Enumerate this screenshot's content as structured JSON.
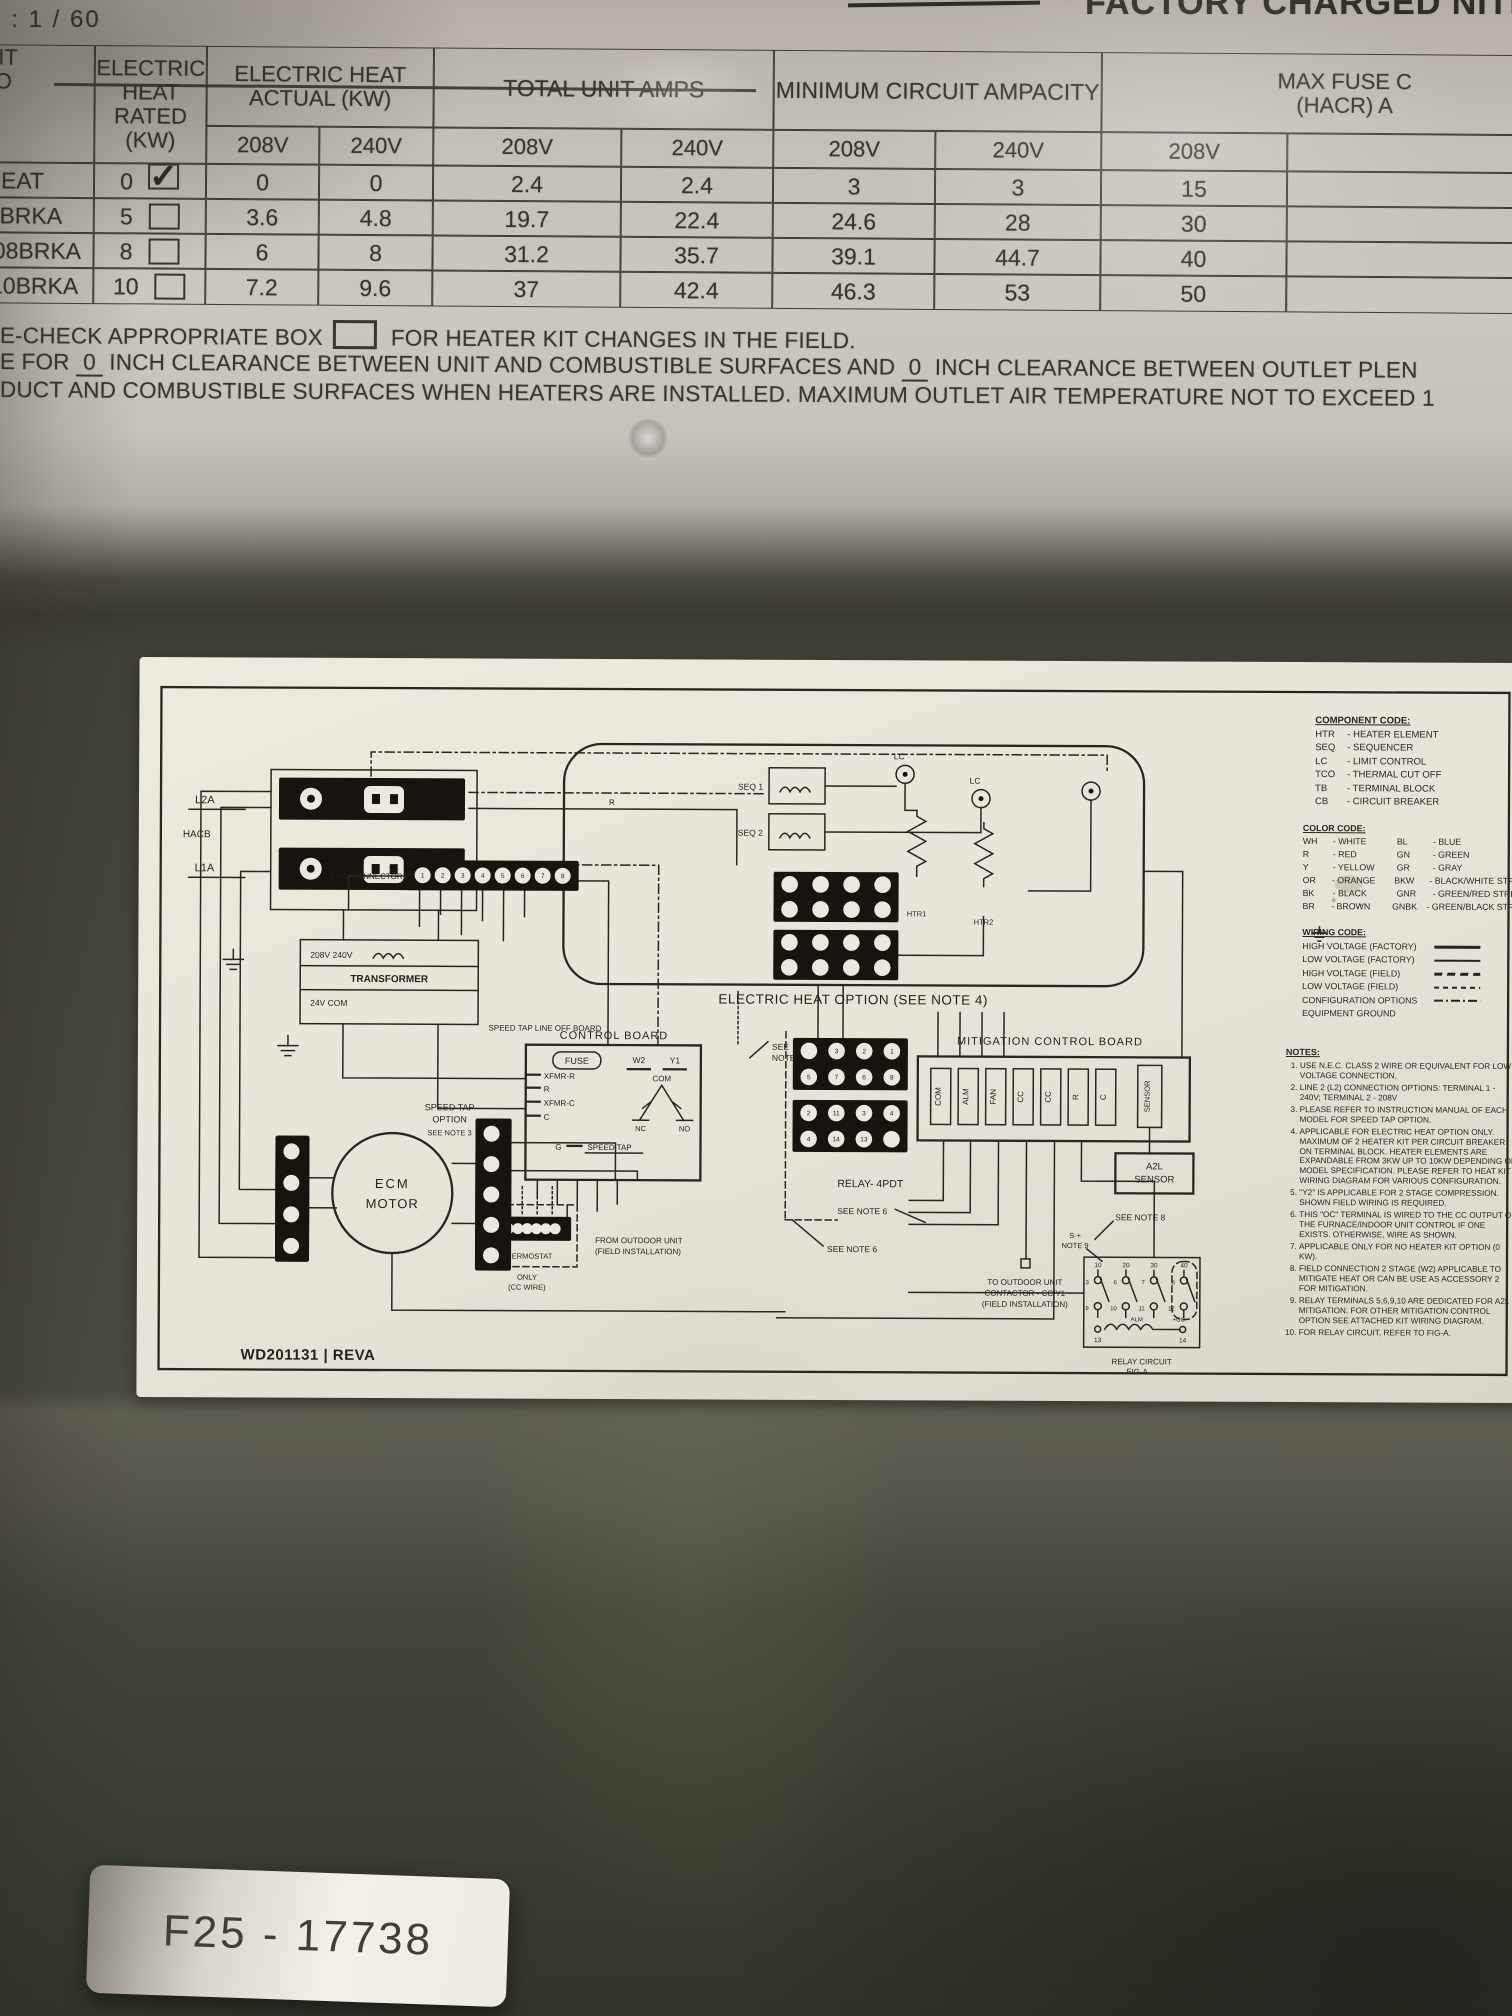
{
  "top": {
    "marker_left": "Z : 1 / 60",
    "marker_right": "FACTORY CHARGED NITROGEN"
  },
  "ratings_table": {
    "headers": {
      "kit1": "ER KIT",
      "kit2": "EL NO",
      "rated1": "ELECTRIC",
      "rated2": "HEAT RATED",
      "rated3": "(KW)",
      "actual1": "ELECTRIC HEAT",
      "actual2": "ACTUAL (KW)",
      "total": "TOTAL UNIT AMPS",
      "mca": "MINIMUM CIRCUIT AMPACITY",
      "fuse1": "MAX FUSE C",
      "fuse2": "(HACR) A",
      "v208": "208V",
      "v240": "240V"
    },
    "rows": [
      {
        "model": "EC HEAT",
        "rated": "0",
        "checked": true,
        "values": [
          "0",
          "0",
          "2.4",
          "2.4",
          "3",
          "3",
          "15"
        ]
      },
      {
        "model": "A505BRKA",
        "rated": "5",
        "checked": false,
        "values": [
          "3.6",
          "4.8",
          "19.7",
          "22.4",
          "24.6",
          "28",
          "30"
        ]
      },
      {
        "model": "RAS08BRKA",
        "rated": "8",
        "checked": false,
        "values": [
          "6",
          "8",
          "31.2",
          "35.7",
          "39.1",
          "44.7",
          "40"
        ]
      },
      {
        "model": "RA510BRKA",
        "rated": "10",
        "checked": false,
        "values": [
          "7.2",
          "9.6",
          "37",
          "42.4",
          "46.3",
          "53",
          "50"
        ]
      }
    ]
  },
  "field_lines": {
    "check1": "E-CHECK APPROPRIATE BOX",
    "check2": "FOR HEATER KIT CHANGES IN THE FIELD.",
    "clearance": [
      "E FOR ",
      "0",
      " INCH CLEARANCE BETWEEN UNIT AND COMBUSTIBLE SURFACES AND ",
      "0",
      " INCH CLEARANCE BETWEEN OUTLET PLEN"
    ],
    "duct": "DUCT AND COMBUSTIBLE SURFACES WHEN HEATERS ARE INSTALLED. MAXIMUM OUTLET AIR TEMPERATURE NOT TO EXCEED 1"
  },
  "diagram": {
    "labels": {
      "l2a": "L2A",
      "hacb": "HACB",
      "l1a": "L1A",
      "xfmr1": "208V  240V",
      "xfmr2": "TRANSFORMER",
      "xfmr3": "24V  COM",
      "lpw": "LPW CONNECTOR",
      "speed_tap_line": "SPEED TAP LINE OFF BOARD",
      "control_board": "CONTROL BOARD",
      "fuse": "FUSE",
      "w2": "W2",
      "y1": "Y1",
      "com": "COM",
      "nc": "NC",
      "no": "NO",
      "xfmr_r": "XFMR-R",
      "r": "R",
      "xfmr_c": "XFMR-C",
      "c": "C",
      "g": "G",
      "speed_tap": "SPEED TAP",
      "wire_r": "R",
      "note7a": "SEE",
      "note7b": "NOTE 7",
      "speed_opt1": "SPEED TAP",
      "speed_opt2": "OPTION",
      "speed_opt3": "SEE NOTE 3",
      "ecm1": "ECM",
      "ecm2": "MOTOR",
      "heat_caption": "ELECTRIC HEAT OPTION (SEE NOTE 4)",
      "seq1": "SEQ 1",
      "seq2": "SEQ 2",
      "lc1": "LC",
      "lc2": "LC",
      "htr1": "HTR1",
      "htr2": "HTR2",
      "mit_title": "MITIGATION CONTROL BOARD",
      "a2l1": "A2L",
      "a2l2": "SENSOR",
      "relay": "RELAY- 4PDT",
      "note6a": "SEE NOTE 6",
      "note6b": "SEE NOTE 6",
      "note8": "SEE NOTE 8",
      "note9a": "S-+",
      "note9b": "NOTE 9",
      "outdoor1": "TO OUTDOOR UNIT",
      "outdoor2": "CONTACTOR - CC/Y1",
      "outdoor3": "(FIELD INSTALLATION)",
      "thermo1": "THERMOSTAT",
      "thermo2": "ONLY",
      "thermo3": "(CC WIRE)",
      "from_outdoor1": "FROM OUTDOOR UNIT",
      "from_outdoor2": "(FIELD INSTALLATION)",
      "fig1": "RELAY CIRCUIT",
      "fig2": "FIG-A",
      "alm": "ALM",
      "pcc": "+CC",
      "wd": "WD201131 | REVA"
    },
    "mitigation": {
      "terminals": [
        "COM",
        "ALM",
        "FAN",
        "CC",
        "CC",
        "R",
        "C"
      ],
      "sensor": "SENSOR"
    },
    "fig": {
      "top": [
        "10",
        "20",
        "30",
        "40"
      ],
      "mid": [
        "3",
        "6",
        "7",
        "8"
      ],
      "low": [
        "9",
        "10",
        "11",
        "12"
      ],
      "bottom": [
        "13",
        "14"
      ]
    },
    "grids": [
      {
        "name": "lpw-connector-strip",
        "x": 268,
        "y": 202,
        "w": 172,
        "h": 30,
        "r": 8,
        "rows": [
          [
            "1",
            "2",
            "3",
            "4",
            "5",
            "6",
            "7",
            "8"
          ]
        ]
      },
      {
        "name": "thermostat-strip",
        "x": 346,
        "y": 558,
        "w": 88,
        "h": 24,
        "r": 5.5,
        "rows": [
          [
            "",
            "",
            "",
            "",
            "",
            "",
            ""
          ]
        ]
      },
      {
        "name": "motor-strip-left",
        "x": 138,
        "y": 478,
        "w": 34,
        "h": 126,
        "r": 8,
        "rows": [
          [
            ""
          ],
          [
            ""
          ],
          [
            ""
          ],
          [
            ""
          ]
        ]
      },
      {
        "name": "motor-strip-right",
        "x": 338,
        "y": 460,
        "w": 36,
        "h": 152,
        "r": 8,
        "rows": [
          [
            ""
          ],
          [
            ""
          ],
          [
            ""
          ],
          [
            ""
          ],
          [
            ""
          ]
        ]
      },
      {
        "name": "heat-terminal-block-a",
        "x": 635,
        "y": 212,
        "w": 125,
        "h": 50,
        "r": 8.3,
        "rows": [
          [
            "",
            "",
            "",
            ""
          ],
          [
            "",
            "",
            "",
            ""
          ]
        ]
      },
      {
        "name": "heat-terminal-block-b",
        "x": 635,
        "y": 270,
        "w": 125,
        "h": 50,
        "r": 8.3,
        "rows": [
          [
            "",
            "",
            "",
            ""
          ],
          [
            "",
            "",
            "",
            ""
          ]
        ]
      },
      {
        "name": "relay-block-a",
        "x": 655,
        "y": 378,
        "w": 115,
        "h": 52,
        "r": 8.3,
        "rows": [
          [
            "",
            "3",
            "2",
            "1"
          ],
          [
            "5",
            "7",
            "6",
            "8"
          ]
        ]
      },
      {
        "name": "relay-block-b",
        "x": 655,
        "y": 440,
        "w": 115,
        "h": 52,
        "r": 8.3,
        "rows": [
          [
            "2",
            "11",
            "3",
            "4"
          ],
          [
            "4",
            "14",
            "13",
            ""
          ]
        ]
      }
    ],
    "legend": {
      "component": {
        "title": "COMPONENT CODE:",
        "items": [
          [
            "HTR",
            "- HEATER ELEMENT"
          ],
          [
            "SEQ",
            "- SEQUENCER"
          ],
          [
            "LC",
            "- LIMIT CONTROL"
          ],
          [
            "TCO",
            "- THERMAL CUT OFF"
          ],
          [
            "TB",
            "- TERMINAL BLOCK"
          ],
          [
            "CB",
            "- CIRCUIT BREAKER"
          ]
        ]
      },
      "color": {
        "title": "COLOR CODE:",
        "rows": [
          [
            "WH",
            "- WHITE",
            "BL",
            "- BLUE"
          ],
          [
            "R",
            "- RED",
            "GN",
            "- GREEN"
          ],
          [
            "Y",
            "- YELLOW",
            "GR",
            "- GRAY"
          ],
          [
            "OR",
            "- ORANGE",
            "BKW",
            "- BLACK/WHITE STRIPE"
          ],
          [
            "BK",
            "- BLACK",
            "GNR",
            "- GREEN/RED STRIPE"
          ],
          [
            "BR",
            "- BROWN",
            "GNBK",
            "- GREEN/BLACK STRIPE"
          ]
        ]
      },
      "wiring": {
        "title": "WIRING CODE:",
        "items": [
          {
            "label": "HIGH VOLTAGE (FACTORY)",
            "style": "solid-thick"
          },
          {
            "label": "LOW VOLTAGE (FACTORY)",
            "style": "solid"
          },
          {
            "label": "HIGH VOLTAGE (FIELD)",
            "style": "dash"
          },
          {
            "label": "LOW VOLTAGE (FIELD)",
            "style": "dash-sm"
          },
          {
            "label": "CONFIGURATION OPTIONS",
            "style": "dashdot"
          },
          {
            "label": "EQUIPMENT GROUND",
            "style": "ground"
          }
        ]
      },
      "notes": {
        "title": "NOTES:",
        "items": [
          "USE N.E.C. CLASS 2 WIRE OR EQUIVALENT FOR LOW VOLTAGE CONNECTION.",
          "LINE 2 (L2) CONNECTION OPTIONS: TERMINAL 1 - 240V; TERMINAL 2 - 208V",
          "PLEASE REFER TO INSTRUCTION MANUAL OF EACH MODEL FOR SPEED TAP OPTION.",
          "APPLICABLE FOR ELECTRIC HEAT OPTION ONLY. MAXIMUM OF 2 HEATER KIT PER CIRCUIT BREAKER ON TERMINAL BLOCK. HEATER ELEMENTS ARE EXPANDABLE FROM 3KW UP TO 10KW DEPENDING ON MODEL SPECIFICATION. PLEASE REFER TO HEAT KIT WIRING DIAGRAM FOR VARIOUS CONFIGURATION.",
          "\"Y2\" IS APPLICABLE FOR 2 STAGE COMPRESSION. SHOWN FIELD WIRING IS REQUIRED.",
          "THIS \"OC\" TERMINAL IS WIRED TO THE CC OUTPUT OF THE FURNACE/INDOOR UNIT CONTROL IF ONE EXISTS. OTHERWISE, WIRE AS SHOWN.",
          "APPLICABLE ONLY FOR NO HEATER KIT OPTION (0 KW).",
          "FIELD CONNECTION 2 STAGE (W2) APPLICABLE TO MITIGATE HEAT OR CAN BE USE AS ACCESSORY 2 FOR MITIGATION.",
          "RELAY TERMINALS 5,6,9,10 ARE DEDICATED FOR A2L MITIGATION. FOR OTHER MITIGATION CONTROL OPTION SEE ATTACHED KIT WIRING DIAGRAM.",
          "FOR RELAY CIRCUIT, REFER TO FIG-A."
        ]
      }
    }
  },
  "sticker": {
    "text": "F25 - 17738"
  }
}
